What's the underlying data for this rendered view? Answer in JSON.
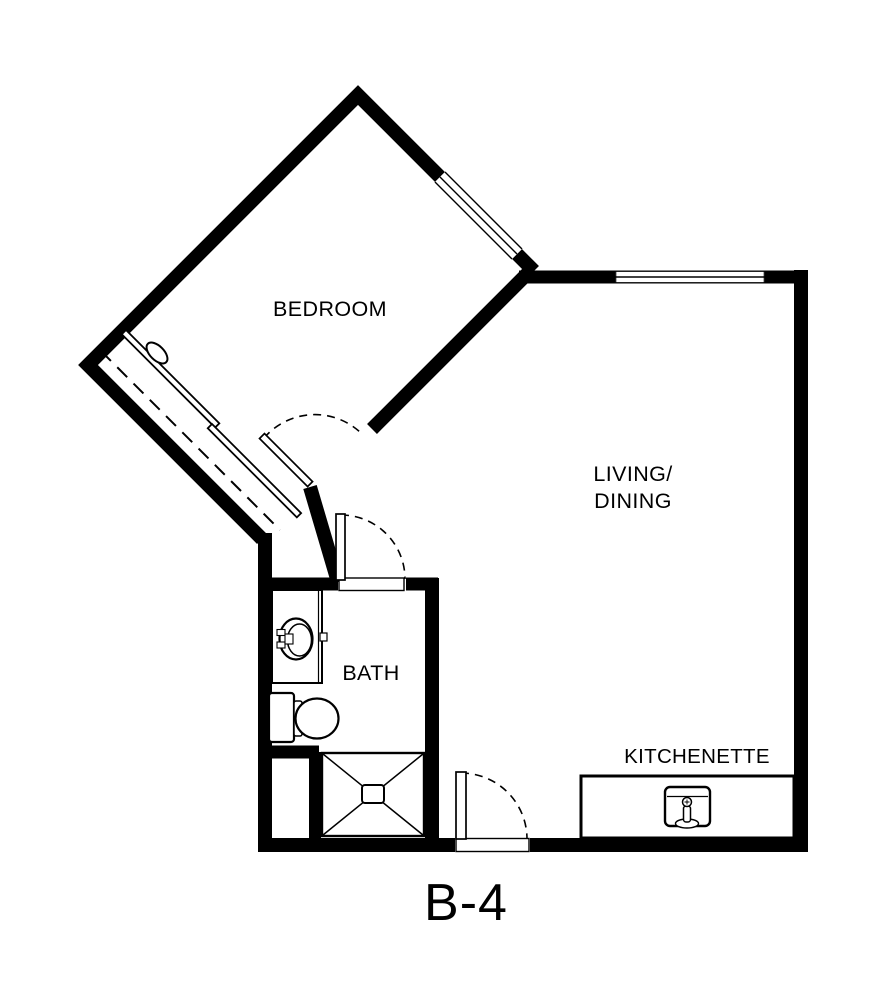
{
  "floor_plan": {
    "unit_label": "B-4",
    "rooms": {
      "bedroom": {
        "label": "BEDROOM"
      },
      "living_dining": {
        "line1": "LIVING/",
        "line2": "DINING"
      },
      "bath": {
        "label": "BATH"
      },
      "kitchenette": {
        "label": "KITCHENETTE"
      }
    },
    "colors": {
      "walls": "#000000",
      "background": "#ffffff"
    },
    "legend": {
      "windows": [
        "bedroom-window",
        "living-dining-window"
      ],
      "doors": [
        "bedroom-door",
        "bath-door",
        "entry-door"
      ],
      "fixtures": [
        "closet-sliding-doors",
        "vanity-sink",
        "toilet",
        "shower",
        "kitchen-counter",
        "kitchen-sink"
      ]
    }
  }
}
